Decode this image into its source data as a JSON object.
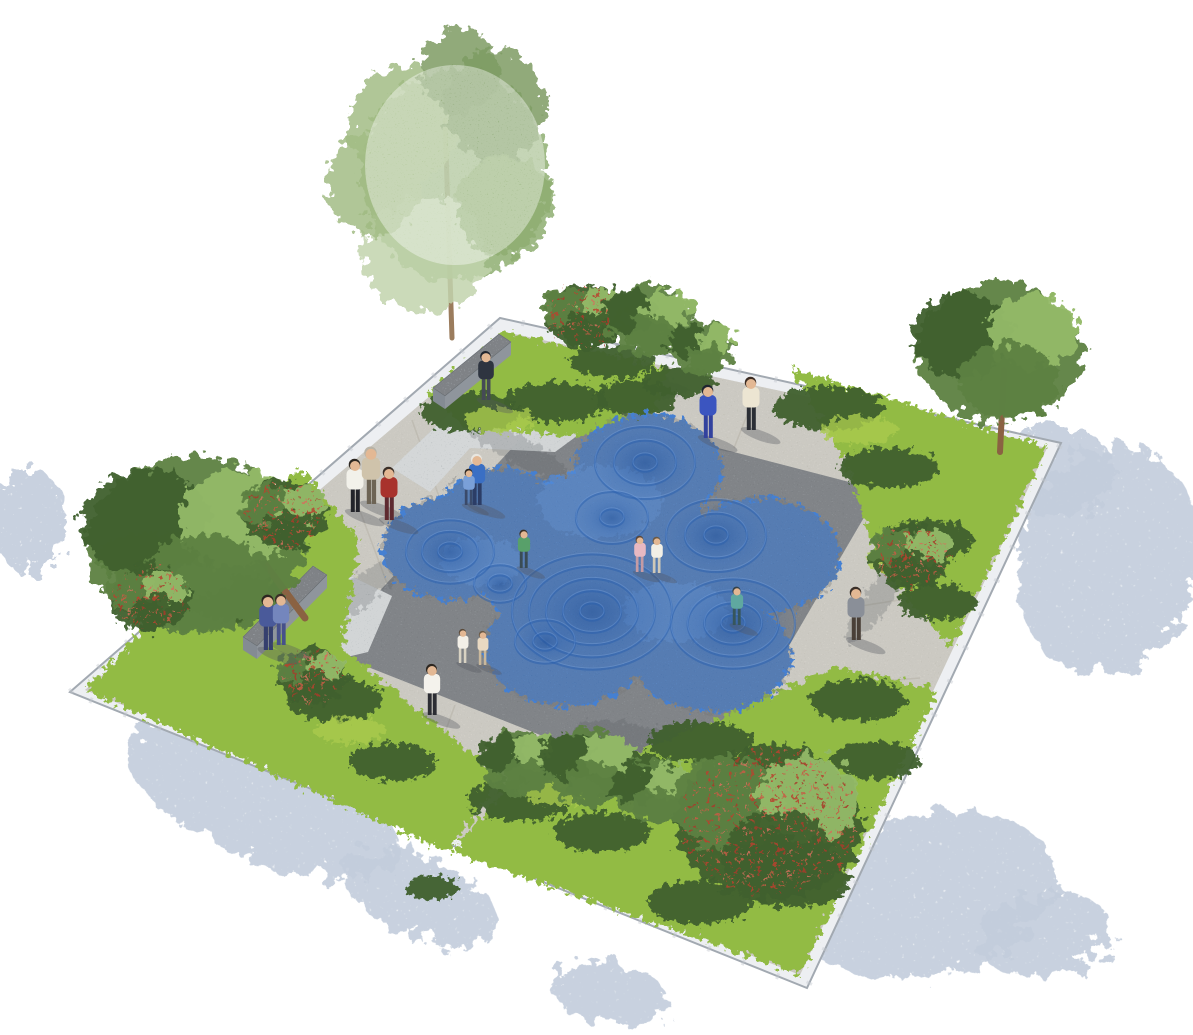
{
  "meta": {
    "title": "plaza-water-feature-rendering",
    "canvas_w": 1193,
    "canvas_h": 1035
  },
  "colors": {
    "background": "#ffffff",
    "curb_top": "#edeff2",
    "curb_side": "#a2a9b1",
    "curb_joint": "#c3c8ce",
    "curb_drop": "#c9ced5",
    "path": "#d3cfc4",
    "plaza": "#8b9095",
    "gravel": "#a8aeb0",
    "joint_line": "#b7b3a8",
    "bed_mid": "#7fae3e",
    "bed_light": "#aacb4e",
    "foliage_dark": "#3f612e",
    "foliage_mid": "#5d8142",
    "foliage_light": "#94ba68",
    "foliage_pale": "#c2d4ad",
    "birch": "#8fae72",
    "trunk": "#8a6242",
    "birch_trunk": "#9b7c5d",
    "apple_red": "#b8432f",
    "water": "#4580d2",
    "water_dark": "#2a5fae",
    "water_light": "#6ea0e4",
    "wall_top": "#b7bcc2",
    "wall_side": "#8f959c",
    "wall_end": "#848b93",
    "shadow_patch": "#c3cddc",
    "blotch": "#565b60",
    "person_shadow": "#52565e",
    "skin": "#e3b894"
  },
  "scene": {
    "curb_quad": "70,692 500,318 1061,443 807,988",
    "outer_quad": "85,690 505,332 1047,448 800,975",
    "inner_quad": "325,650 552,405 880,490 700,798",
    "curb_drop_path": "M85,690 L800,975 L1047,448",
    "gravel_strips": [
      "392,468 468,396 585,430 555,452 470,448 430,492",
      "246,642 330,566 392,596 368,652 300,668"
    ],
    "beds": [
      {
        "name": "bed-left-corner",
        "points": "300,468 85,690 448,852 502,778 342,648 360,540"
      },
      {
        "name": "bed-top-corner",
        "points": "428,392 505,332 668,368 648,428 560,436 462,426"
      },
      {
        "name": "bed-right-corner",
        "points": "792,368 1047,448 952,648 878,566 850,470"
      },
      {
        "name": "bed-bottom-corner",
        "points": "938,690 800,975 452,852 512,780 648,748 838,666"
      }
    ],
    "walls": [
      {
        "name": "seat-wall-top",
        "top": "433,388 499,334 511,342 445,396",
        "front": "445,396 511,342 511,355 445,409",
        "end": "433,388 445,396 445,409 433,401"
      },
      {
        "name": "seat-wall-left",
        "top": "243,637 313,566 327,575 257,646",
        "front": "257,646 327,575 327,588 257,659",
        "end": "243,637 257,646 257,659 243,650"
      }
    ],
    "joints": [
      [
        448,
        522,
        412,
        420
      ],
      [
        388,
        586,
        350,
        484
      ],
      [
        757,
        390,
        734,
        448
      ],
      [
        862,
        414,
        840,
        470
      ],
      [
        952,
        434,
        932,
        488
      ],
      [
        905,
        518,
        1013,
        494
      ],
      [
        848,
        608,
        976,
        588
      ],
      [
        800,
        688,
        920,
        678
      ],
      [
        360,
        668,
        327,
        751
      ],
      [
        455,
        705,
        424,
        790
      ]
    ],
    "water": {
      "lobes": [
        [
          648,
          468,
          74,
          54
        ],
        [
          452,
          548,
          70,
          52
        ],
        [
          600,
          560,
          122,
          90
        ],
        [
          760,
          556,
          80,
          58
        ],
        [
          712,
          656,
          80,
          56
        ],
        [
          566,
          648,
          82,
          58
        ],
        [
          500,
          510,
          58,
          42
        ],
        [
          676,
          606,
          70,
          52
        ]
      ],
      "craters": [
        [
          645,
          463,
          50,
          3
        ],
        [
          612,
          518,
          36,
          2
        ],
        [
          450,
          552,
          44,
          3
        ],
        [
          500,
          584,
          26,
          2
        ],
        [
          592,
          612,
          80,
          5
        ],
        [
          716,
          536,
          50,
          3
        ],
        [
          733,
          624,
          62,
          4
        ],
        [
          545,
          642,
          30,
          2
        ]
      ],
      "highlights": [
        [
          600,
          502,
          62,
          36
        ],
        [
          676,
          612,
          52,
          30
        ],
        [
          482,
          562,
          40,
          24
        ]
      ]
    },
    "shadow_patches": [
      [
        1108,
        560,
        90,
        115,
        15
      ],
      [
        1058,
        470,
        55,
        45,
        0
      ],
      [
        925,
        895,
        135,
        80,
        -12
      ],
      [
        1045,
        935,
        65,
        42,
        -12
      ],
      [
        262,
        800,
        145,
        58,
        22
      ],
      [
        420,
        898,
        82,
        40,
        22
      ],
      [
        28,
        520,
        38,
        52,
        0
      ],
      [
        610,
        995,
        60,
        30,
        10
      ]
    ],
    "blotches": [
      [
        600,
        374,
        88,
        16,
        12
      ],
      [
        352,
        598,
        66,
        15,
        -38
      ],
      [
        878,
        598,
        55,
        13,
        -55
      ],
      [
        652,
        742,
        78,
        15,
        12
      ],
      [
        515,
        448,
        62,
        14,
        30
      ]
    ],
    "shrubs": [
      [
        470,
        412,
        50,
        20
      ],
      [
        555,
        402,
        52,
        20
      ],
      [
        635,
        398,
        42,
        17
      ],
      [
        828,
        408,
        55,
        22
      ],
      [
        888,
        468,
        50,
        20
      ],
      [
        928,
        540,
        45,
        20
      ],
      [
        938,
        602,
        40,
        18
      ],
      [
        155,
        558,
        58,
        25
      ],
      [
        235,
        598,
        52,
        23
      ],
      [
        250,
        502,
        46,
        19
      ],
      [
        335,
        700,
        48,
        21
      ],
      [
        392,
        762,
        44,
        19
      ],
      [
        520,
        800,
        52,
        21
      ],
      [
        618,
        772,
        56,
        22
      ],
      [
        700,
        742,
        52,
        21
      ],
      [
        858,
        700,
        48,
        21
      ],
      [
        792,
        882,
        58,
        25
      ],
      [
        700,
        902,
        52,
        22
      ],
      [
        602,
        832,
        48,
        20
      ],
      [
        876,
        760,
        44,
        19
      ],
      [
        612,
        362,
        42,
        17
      ],
      [
        678,
        382,
        38,
        15
      ],
      [
        432,
        888,
        26,
        12
      ]
    ],
    "tufts": [
      [
        500,
        420,
        35,
        13
      ],
      [
        860,
        430,
        38,
        14
      ],
      [
        190,
        580,
        44,
        16
      ],
      [
        560,
        790,
        40,
        15
      ],
      [
        760,
        860,
        44,
        16
      ],
      [
        900,
        560,
        32,
        12
      ],
      [
        350,
        730,
        36,
        13
      ]
    ],
    "trees": [
      {
        "name": "birch-tree",
        "type": "birch",
        "cx": 452,
        "cy": 175,
        "r": 100,
        "trunk": [
          452,
          338,
          445,
          120,
          5
        ]
      },
      {
        "name": "apple-tree",
        "type": "apple",
        "cx": 585,
        "cy": 316,
        "r": 40
      },
      {
        "name": "green-tree",
        "type": "green",
        "cx": 650,
        "cy": 320,
        "r": 44
      },
      {
        "name": "green-tree",
        "type": "green",
        "cx": 702,
        "cy": 348,
        "r": 32
      },
      {
        "name": "green-tall-tree",
        "type": "green",
        "cx": 1000,
        "cy": 352,
        "r": 84,
        "trunk": [
          1000,
          452,
          1004,
          370,
          6
        ]
      },
      {
        "name": "apple-tree",
        "type": "apple",
        "cx": 912,
        "cy": 556,
        "r": 40
      },
      {
        "name": "big-tree",
        "type": "green",
        "cx": 195,
        "cy": 545,
        "r": 108,
        "trunk": [
          305,
          618,
          262,
          560,
          7
        ]
      },
      {
        "name": "apple-tree",
        "type": "apple",
        "cx": 285,
        "cy": 515,
        "r": 42
      },
      {
        "name": "apple-tree",
        "type": "apple",
        "cx": 150,
        "cy": 598,
        "r": 40
      },
      {
        "name": "apple-tree",
        "type": "apple",
        "cx": 312,
        "cy": 676,
        "r": 34
      },
      {
        "name": "green-tree",
        "type": "green",
        "cx": 520,
        "cy": 762,
        "r": 40
      },
      {
        "name": "green-tree",
        "type": "green",
        "cx": 588,
        "cy": 766,
        "r": 46
      },
      {
        "name": "green-tree",
        "type": "green",
        "cx": 652,
        "cy": 792,
        "r": 38
      },
      {
        "name": "apple-big-tree",
        "type": "apple",
        "cx": 770,
        "cy": 822,
        "r": 94,
        "trunk": [
          770,
          880,
          778,
          800,
          7
        ]
      }
    ],
    "people": [
      [
        355,
        512,
        50,
        "#f2f1ea",
        "#23242a",
        "#2c2620",
        "man-white-shirt"
      ],
      [
        371,
        504,
        54,
        "#cfc3ab",
        "#6d6455",
        "#b9b3a6",
        "man-beige"
      ],
      [
        389,
        520,
        50,
        "#a8322c",
        "#5e2a30",
        "#3a2f28",
        "woman-red-dress"
      ],
      [
        486,
        400,
        46,
        "#2e3440",
        "#454a56",
        "#20252e",
        "person-at-wall"
      ],
      [
        477,
        505,
        48,
        "#3a6fc4",
        "#2c3d66",
        "#e8e6e0",
        "photographer-blue"
      ],
      [
        469,
        505,
        34,
        "#7aa0d8",
        "#3a4a6a",
        "#2c2620",
        "child-with-photographer"
      ],
      [
        708,
        438,
        50,
        "#3b55c0",
        "#32429e",
        "#1f2430",
        "person-blue-robe"
      ],
      [
        751,
        430,
        50,
        "#ece5d2",
        "#2b2e35",
        "#3a2b22",
        "woman-white-top"
      ],
      [
        856,
        640,
        50,
        "#8a8f98",
        "#4a4038",
        "#3a2f28",
        "woman-with-basket"
      ],
      [
        737,
        625,
        36,
        "#5fa8a0",
        "#37565c",
        "#35424a",
        "child-teal"
      ],
      [
        640,
        572,
        34,
        "#e8b9c2",
        "#c59ba4",
        "#5a4638",
        "child-pink"
      ],
      [
        657,
        573,
        34,
        "#f2efe6",
        "#cfc8b8",
        "#6b5a46",
        "child-white"
      ],
      [
        524,
        568,
        36,
        "#58a06a",
        "#3a4c55",
        "#3a3026",
        "child-green"
      ],
      [
        463,
        663,
        32,
        "#f3f0e8",
        "#d8d2c2",
        "#5a4a3a",
        "child-pair-a"
      ],
      [
        483,
        665,
        32,
        "#e9d9c2",
        "#c9b89c",
        "#6b5a46",
        "child-pair-b"
      ],
      [
        268,
        650,
        52,
        "#4a5a9a",
        "#353f6e",
        "#2c2620",
        "couple-figure-a"
      ],
      [
        281,
        645,
        48,
        "#7486bd",
        "#46508a",
        "#3a2f28",
        "couple-figure-b"
      ],
      [
        432,
        715,
        48,
        "#f4f2ec",
        "#2c2d33",
        "#2c2620",
        "man-walking"
      ]
    ]
  }
}
